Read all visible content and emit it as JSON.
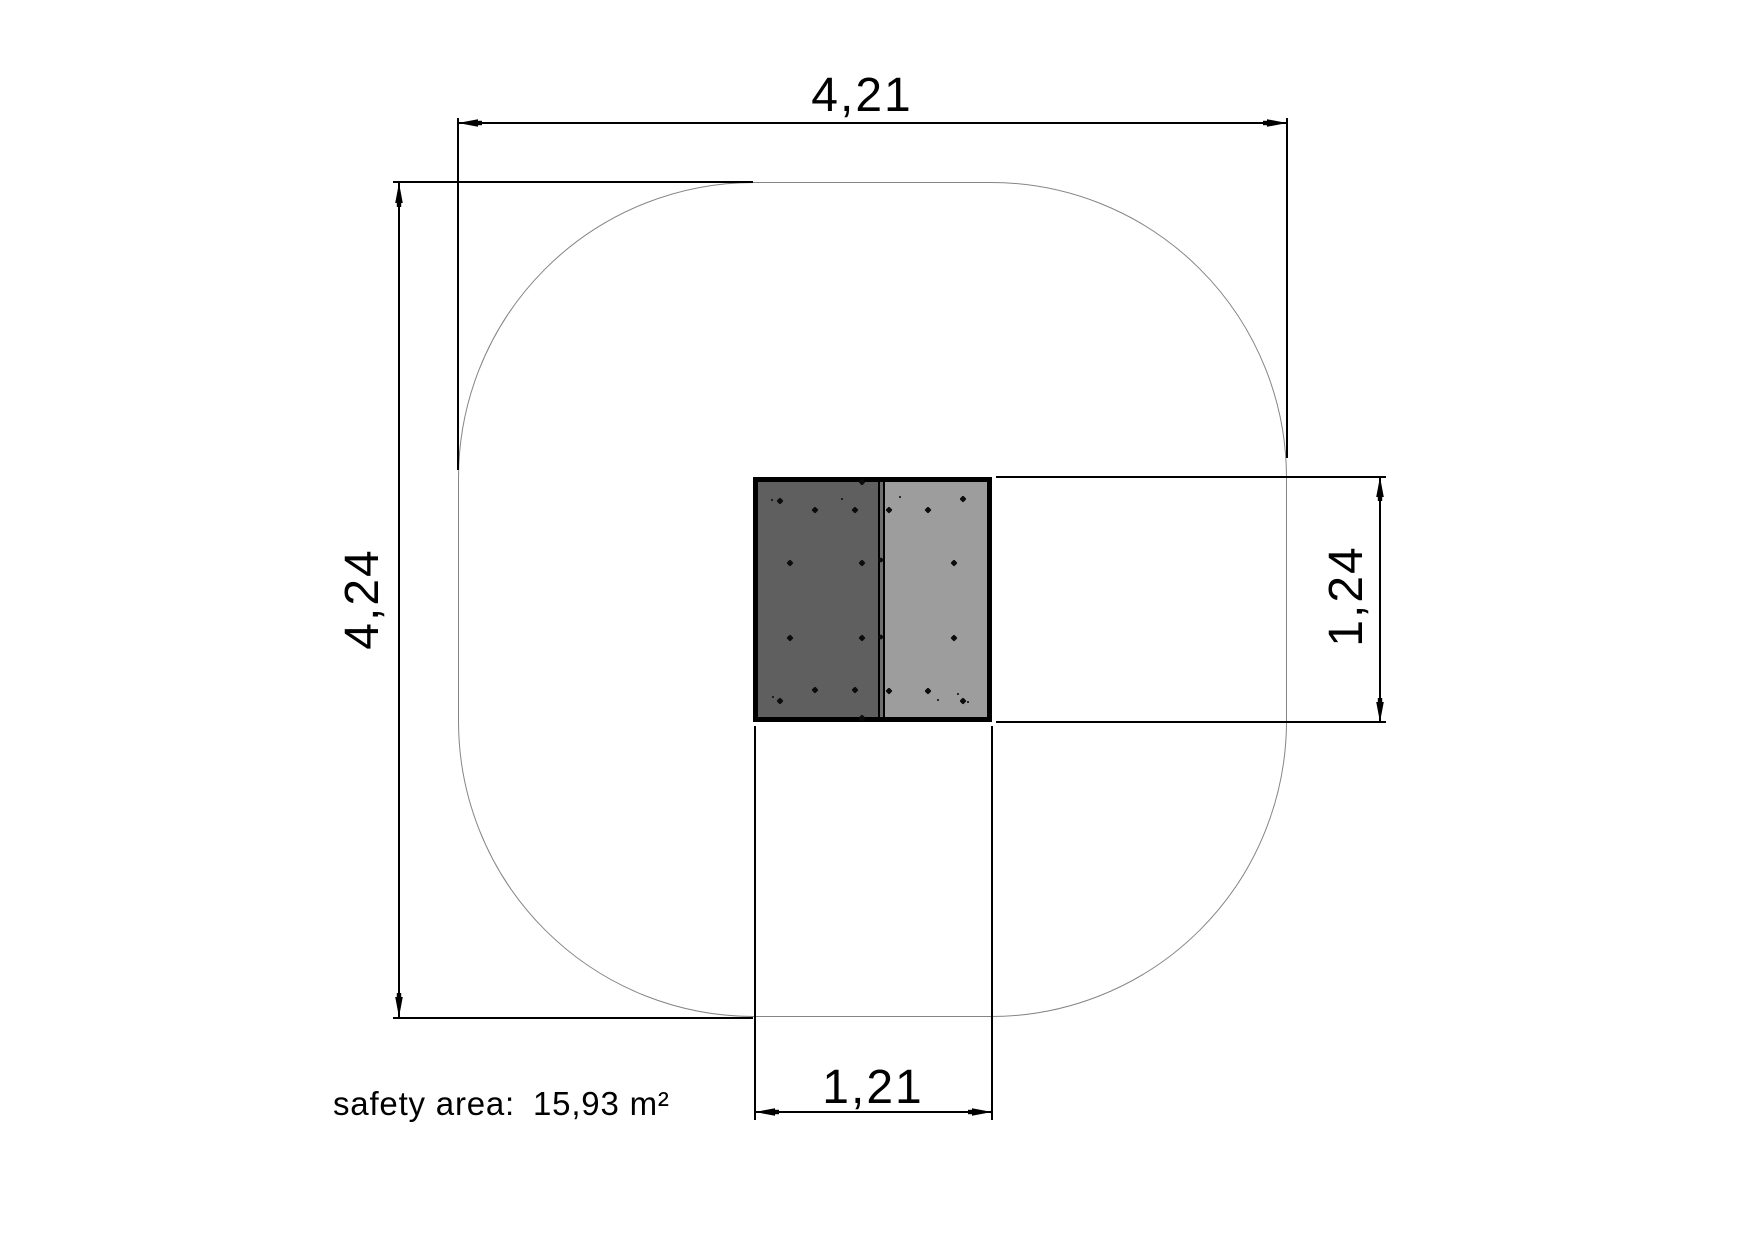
{
  "dimensions": {
    "overall_width": {
      "value": "4,21"
    },
    "overall_height": {
      "value": "4,24"
    },
    "item_height": {
      "value": "1,24"
    },
    "item_width": {
      "value": "1,21"
    }
  },
  "safety_area": {
    "label": "safety area:",
    "value": "15,93 m²"
  },
  "colors": {
    "background": "#ffffff",
    "line": "#000000",
    "safety_outline": "#858585",
    "panel_left": "#5f5f5f",
    "panel_right": "#9d9d9d",
    "divider_core": "#6e6e6e",
    "dot": "#0c0c0c"
  },
  "device": {
    "dots": [
      {
        "x": 780,
        "y": 501,
        "s": 5
      },
      {
        "x": 815,
        "y": 510,
        "s": 5
      },
      {
        "x": 855,
        "y": 510,
        "s": 5
      },
      {
        "x": 862,
        "y": 482,
        "s": 5
      },
      {
        "x": 790,
        "y": 563,
        "s": 5
      },
      {
        "x": 862,
        "y": 563,
        "s": 5
      },
      {
        "x": 790,
        "y": 638,
        "s": 5
      },
      {
        "x": 862,
        "y": 638,
        "s": 5
      },
      {
        "x": 815,
        "y": 690,
        "s": 5
      },
      {
        "x": 855,
        "y": 690,
        "s": 5
      },
      {
        "x": 780,
        "y": 701,
        "s": 5
      },
      {
        "x": 862,
        "y": 718,
        "s": 5
      },
      {
        "x": 881,
        "y": 560,
        "s": 4
      },
      {
        "x": 881,
        "y": 637,
        "s": 4
      },
      {
        "x": 889,
        "y": 510,
        "s": 5
      },
      {
        "x": 928,
        "y": 510,
        "s": 5
      },
      {
        "x": 963,
        "y": 499,
        "s": 5
      },
      {
        "x": 954,
        "y": 563,
        "s": 5
      },
      {
        "x": 954,
        "y": 638,
        "s": 5
      },
      {
        "x": 889,
        "y": 691,
        "s": 5
      },
      {
        "x": 928,
        "y": 691,
        "s": 5
      },
      {
        "x": 963,
        "y": 701,
        "s": 5
      },
      {
        "x": 772,
        "y": 500,
        "s": 2
      },
      {
        "x": 842,
        "y": 499,
        "s": 2
      },
      {
        "x": 900,
        "y": 497,
        "s": 2
      },
      {
        "x": 773,
        "y": 697,
        "s": 2
      },
      {
        "x": 938,
        "y": 700,
        "s": 2
      },
      {
        "x": 958,
        "y": 694,
        "s": 2
      },
      {
        "x": 968,
        "y": 702,
        "s": 2
      }
    ]
  }
}
